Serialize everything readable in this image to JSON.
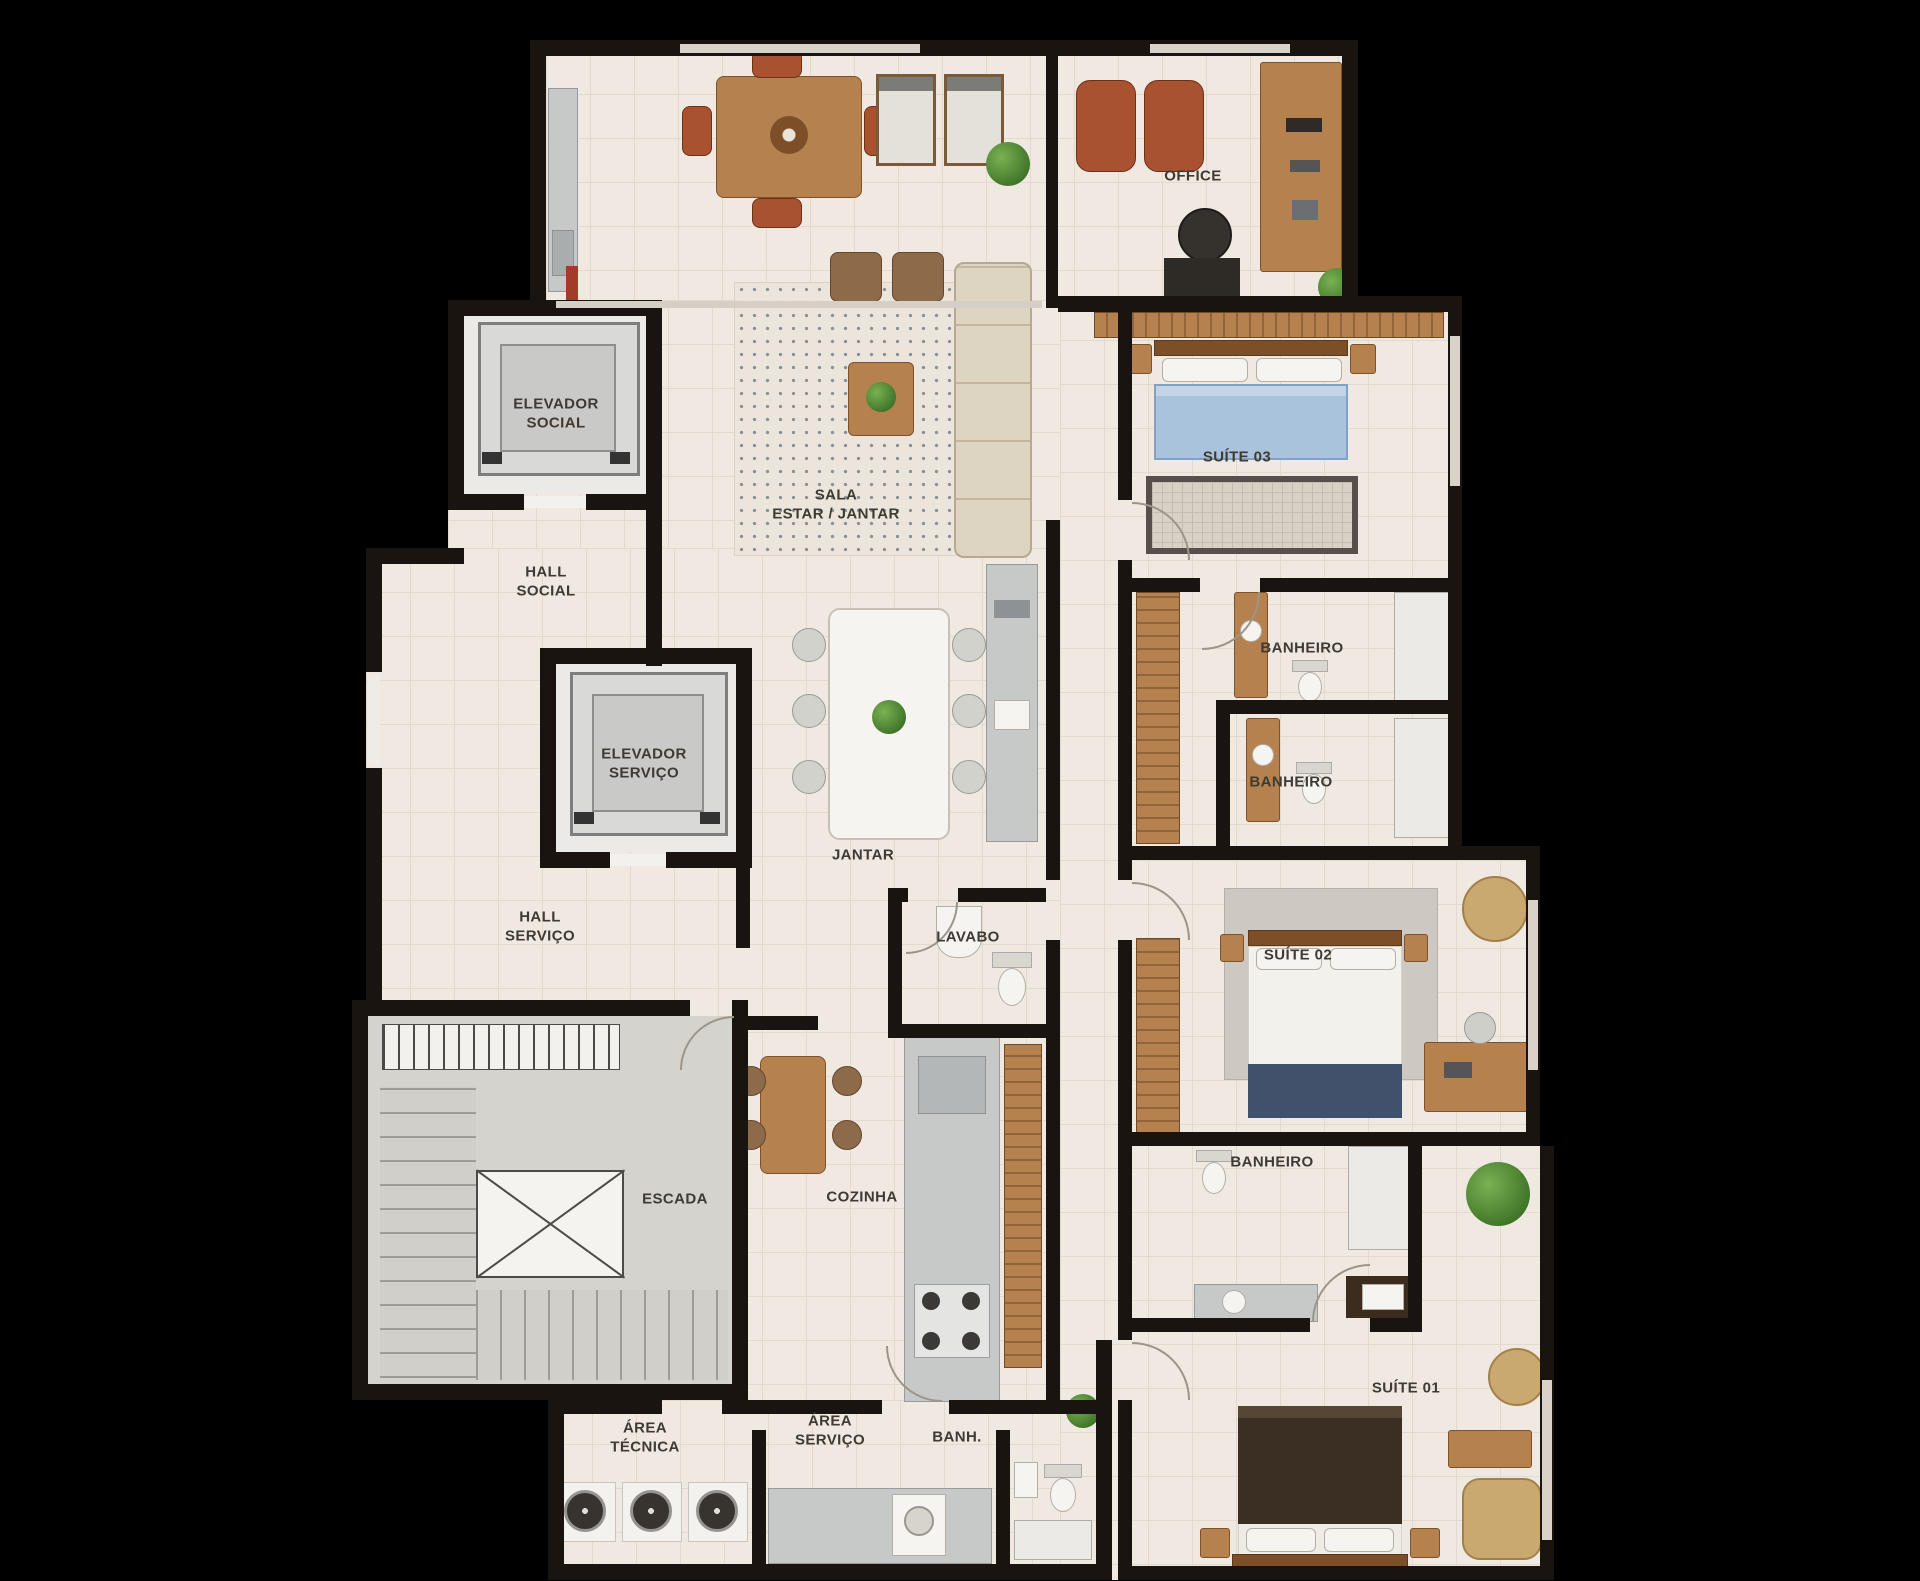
{
  "plan": {
    "type": "apartment-floor-plan",
    "language": "pt-BR"
  },
  "palette": {
    "background": "#000000",
    "wall": "#1a1410",
    "floor": "#f0e9e1",
    "floor_line": "#e3dacf",
    "stair_gray": "#d4d3ce",
    "elevator_gray": "#d9d9d7",
    "wood": "#b5824f",
    "accent_chair_red": "#a85231",
    "bed_blue": "#a9c3dc",
    "bed_dark": "#3b2e22",
    "plant_green": "#3f7328",
    "steel_gray": "#c7c9c8",
    "sofa_beige": "#ded4c2"
  },
  "rooms": {
    "office": {
      "label": "OFFICE"
    },
    "elevador_social": {
      "label": "ELEVADOR\nSOCIAL"
    },
    "sala": {
      "label": "SALA\nESTAR / JANTAR"
    },
    "suite03": {
      "label": "SUÍTE 03"
    },
    "hall_social": {
      "label": "HALL\nSOCIAL"
    },
    "banheiro1": {
      "label": "BANHEIRO"
    },
    "elevador_servico": {
      "label": "ELEVADOR\nSERVIÇO"
    },
    "banheiro2": {
      "label": "BANHEIRO"
    },
    "jantar": {
      "label": "JANTAR"
    },
    "hall_servico": {
      "label": "HALL\nSERVIÇO"
    },
    "lavabo": {
      "label": "LAVABO"
    },
    "suite02": {
      "label": "SUÍTE 02"
    },
    "banheiro3": {
      "label": "BANHEIRO"
    },
    "escada": {
      "label": "ESCADA"
    },
    "cozinha": {
      "label": "COZINHA"
    },
    "suite01": {
      "label": "SUÍTE 01"
    },
    "area_tecnica": {
      "label": "ÁREA\nTÉCNICA"
    },
    "area_servico": {
      "label": "ÁREA\nSERVIÇO"
    },
    "banh": {
      "label": "BANH."
    }
  }
}
